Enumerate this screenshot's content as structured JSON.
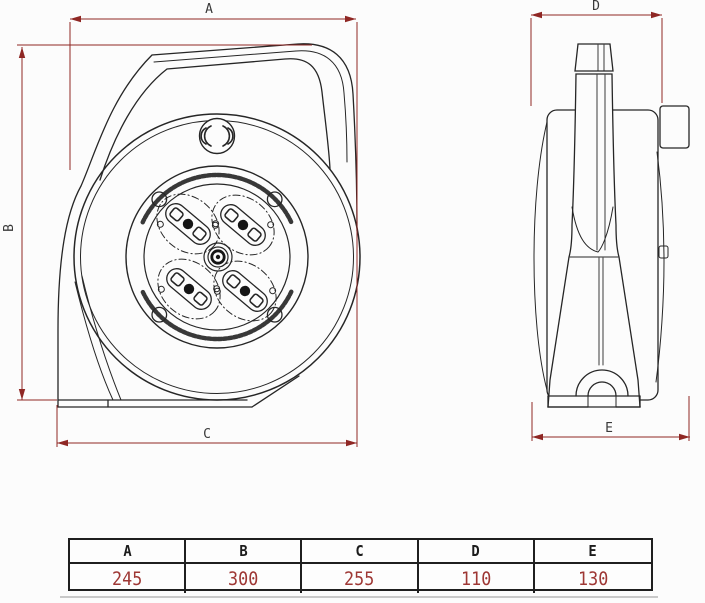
{
  "title": "cable-reel technical drawing, front and side orthographic views with dimension table",
  "dimensions": [
    {
      "label": "A",
      "value": "245"
    },
    {
      "label": "B",
      "value": "300"
    },
    {
      "label": "C",
      "value": "255"
    },
    {
      "label": "D",
      "value": "110"
    },
    {
      "label": "E",
      "value": "130"
    }
  ],
  "views": {
    "front": "front view of cable reel with handle, drum and 4-socket face plate",
    "side": "side profile view of cable reel with stand foot and side socket box"
  },
  "colors": {
    "dimension_line": "#8f2724",
    "value_text": "#9e3734",
    "drawing_line": "#262626",
    "table_border": "#1f1f1f",
    "background": "#fcfcfc"
  }
}
